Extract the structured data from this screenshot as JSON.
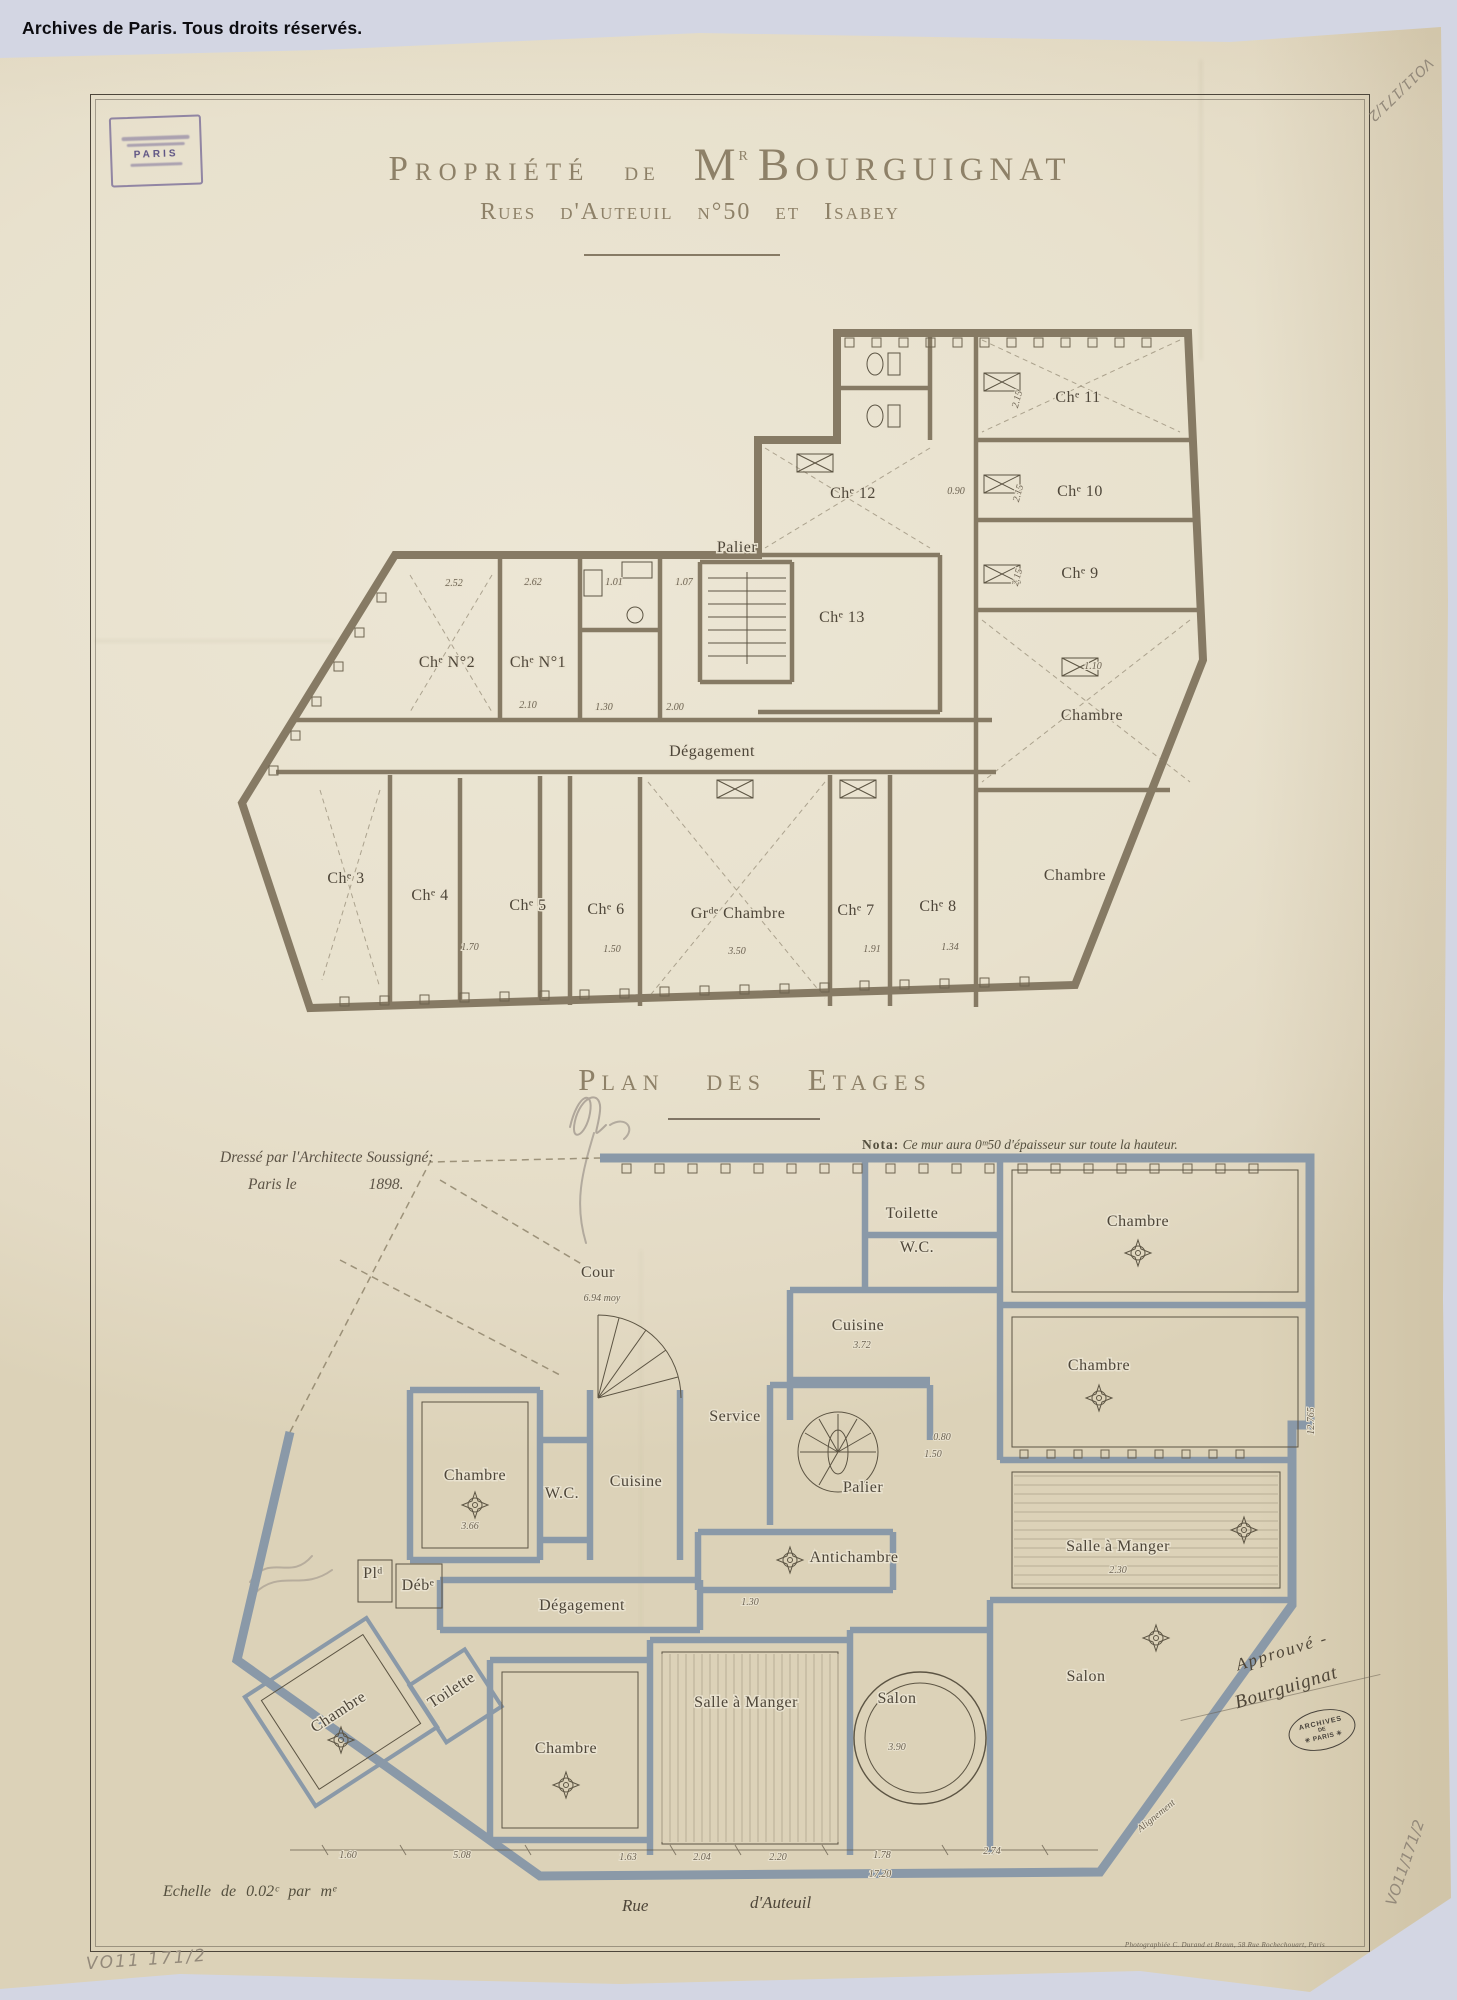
{
  "page": {
    "copyright": "Archives de Paris. Tous droits réservés."
  },
  "corner_stamp": {
    "city": "PARIS"
  },
  "title": {
    "part1": "Propriété",
    "part2": "de",
    "owner_initial": "M",
    "owner_sup": "r",
    "owner_name": "Bourguignat",
    "subtitle": "Rues d'Auteuil n°50 et Isabey"
  },
  "plan1": {
    "rooms": [
      {
        "label": "Chᵉ N°2",
        "x": 217,
        "y": 347
      },
      {
        "label": "Chᵉ N°1",
        "x": 308,
        "y": 347
      },
      {
        "label": "Palier",
        "x": 507,
        "y": 232,
        "fs": 13
      },
      {
        "label": "Chᵉ 12",
        "x": 623,
        "y": 178
      },
      {
        "label": "Chᵉ 13",
        "x": 612,
        "y": 302
      },
      {
        "label": "Chᵉ 11",
        "x": 848,
        "y": 82
      },
      {
        "label": "Chᵉ 10",
        "x": 850,
        "y": 176
      },
      {
        "label": "Chᵉ 9",
        "x": 850,
        "y": 258
      },
      {
        "label": "Chambre",
        "x": 862,
        "y": 400
      },
      {
        "label": "Chambre",
        "x": 845,
        "y": 560
      },
      {
        "label": "Dégagement",
        "x": 482,
        "y": 436,
        "fs": 14
      },
      {
        "label": "Chᵉ 3",
        "x": 116,
        "y": 563
      },
      {
        "label": "Chᵉ 4",
        "x": 200,
        "y": 580
      },
      {
        "label": "Chᵉ 5",
        "x": 298,
        "y": 590
      },
      {
        "label": "Chᵉ 6",
        "x": 376,
        "y": 594
      },
      {
        "label": "Grᵈᵉ Chambre",
        "x": 508,
        "y": 598,
        "fs": 15
      },
      {
        "label": "Chᵉ 7",
        "x": 626,
        "y": 595
      },
      {
        "label": "Chᵉ 8",
        "x": 708,
        "y": 591
      }
    ],
    "dims": [
      {
        "t": "2.52",
        "x": 224,
        "y": 266
      },
      {
        "t": "2.62",
        "x": 303,
        "y": 265
      },
      {
        "t": "1.01",
        "x": 384,
        "y": 265
      },
      {
        "t": "1.07",
        "x": 454,
        "y": 265
      },
      {
        "t": "2.10",
        "x": 298,
        "y": 388
      },
      {
        "t": "1.30",
        "x": 374,
        "y": 390
      },
      {
        "t": "2.00",
        "x": 445,
        "y": 390
      },
      {
        "t": "0.90",
        "x": 726,
        "y": 174
      },
      {
        "t": "2.15",
        "x": 790,
        "y": 80,
        "r": -75
      },
      {
        "t": "2.15",
        "x": 791,
        "y": 174,
        "r": -75
      },
      {
        "t": "2.15",
        "x": 790,
        "y": 258,
        "r": -75
      },
      {
        "t": "1.10",
        "x": 863,
        "y": 349
      },
      {
        "t": "1.70",
        "x": 240,
        "y": 630
      },
      {
        "t": "1.50",
        "x": 382,
        "y": 632
      },
      {
        "t": "3.50",
        "x": 507,
        "y": 634
      },
      {
        "t": "1.91",
        "x": 642,
        "y": 632
      },
      {
        "t": "1.34",
        "x": 720,
        "y": 630
      }
    ]
  },
  "plan2": {
    "title": "Plan des Etages",
    "nota_label": "Nota:",
    "nota_text": "Ce mur aura 0ᵐ50 d'épaisseur sur toute la hauteur.",
    "drafter_line1": "Dressé par l'Architecte Soussigné:",
    "drafter_city": "Paris le",
    "drafter_year": "1898.",
    "rooms": [
      {
        "label": "Toilette",
        "x": 682,
        "y": 78,
        "fs": 11
      },
      {
        "label": "W.C.",
        "x": 687,
        "y": 112,
        "fs": 11
      },
      {
        "label": "Chambre",
        "x": 908,
        "y": 86
      },
      {
        "label": "Chambre",
        "x": 869,
        "y": 230
      },
      {
        "label": "Cuisine",
        "x": 628,
        "y": 190,
        "fs": 13
      },
      {
        "label": "Cour",
        "x": 368,
        "y": 137,
        "fs": 14
      },
      {
        "label": "Service",
        "x": 505,
        "y": 281,
        "fs": 13
      },
      {
        "label": "Chambre",
        "x": 245,
        "y": 340
      },
      {
        "label": "W.C.",
        "x": 332,
        "y": 358,
        "fs": 9
      },
      {
        "label": "Cuisine",
        "x": 406,
        "y": 346,
        "fs": 12
      },
      {
        "label": "Palier",
        "x": 633,
        "y": 352,
        "fs": 13
      },
      {
        "label": "Salle à Manger",
        "x": 888,
        "y": 411
      },
      {
        "label": "Plᵈ",
        "x": 143,
        "y": 438,
        "fs": 10
      },
      {
        "label": "Débᵉ",
        "x": 188,
        "y": 450,
        "fs": 10
      },
      {
        "label": "Dégagement",
        "x": 352,
        "y": 470,
        "fs": 13
      },
      {
        "label": "Antichambre",
        "x": 624,
        "y": 422
      },
      {
        "label": "Chambre",
        "x": 111,
        "y": 576,
        "r": -33
      },
      {
        "label": "Toilette",
        "x": 224,
        "y": 554,
        "fs": 11,
        "r": -33
      },
      {
        "label": "Chambre",
        "x": 336,
        "y": 613
      },
      {
        "label": "Salle à Manger",
        "x": 516,
        "y": 567
      },
      {
        "label": "Salon",
        "x": 667,
        "y": 563
      },
      {
        "label": "Salon",
        "x": 856,
        "y": 541
      }
    ],
    "dims": [
      {
        "t": "6.94 moy",
        "x": 372,
        "y": 161
      },
      {
        "t": "3.72",
        "x": 632,
        "y": 208
      },
      {
        "t": "1.50",
        "x": 703,
        "y": 317
      },
      {
        "t": "0.80",
        "x": 712,
        "y": 300
      },
      {
        "t": "3.66",
        "x": 240,
        "y": 389
      },
      {
        "t": "1.30",
        "x": 520,
        "y": 465
      },
      {
        "t": "3.90",
        "x": 667,
        "y": 610
      },
      {
        "t": "2.30",
        "x": 888,
        "y": 433
      },
      {
        "t": "12.765",
        "x": 1084,
        "y": 281,
        "r": -90
      },
      {
        "t": "1.60",
        "x": 118,
        "y": 718
      },
      {
        "t": "5.08",
        "x": 232,
        "y": 718
      },
      {
        "t": "1.63",
        "x": 398,
        "y": 720
      },
      {
        "t": "2.04",
        "x": 472,
        "y": 720
      },
      {
        "t": "2.20",
        "x": 548,
        "y": 720
      },
      {
        "t": "1.78",
        "x": 652,
        "y": 718
      },
      {
        "t": "2.74",
        "x": 762,
        "y": 714
      },
      {
        "t": "17.20",
        "x": 650,
        "y": 737
      },
      {
        "t": "Alignement",
        "x": 928,
        "y": 678,
        "r": -39,
        "fs": 12
      }
    ]
  },
  "footer": {
    "scale": "Echelle de 0.02ᶜ par mᵉ",
    "street1": "Rue",
    "street2": "d'Auteuil",
    "photo_credit": "Photographiée C. Durand et Braun, 58 Rue Rochechouart, Paris"
  },
  "annotations": {
    "approval_line1": "Approuvé -",
    "approval_line2": "Bourguignat",
    "ref_top_right": "VO11/171/2",
    "ref_right": "VO11/171/2",
    "ref_bottom_left": "VO11 171/2"
  },
  "oval_stamp": {
    "line1": "ARCHIVES",
    "line2": "DE",
    "line3": "✳ PARIS ✳"
  }
}
